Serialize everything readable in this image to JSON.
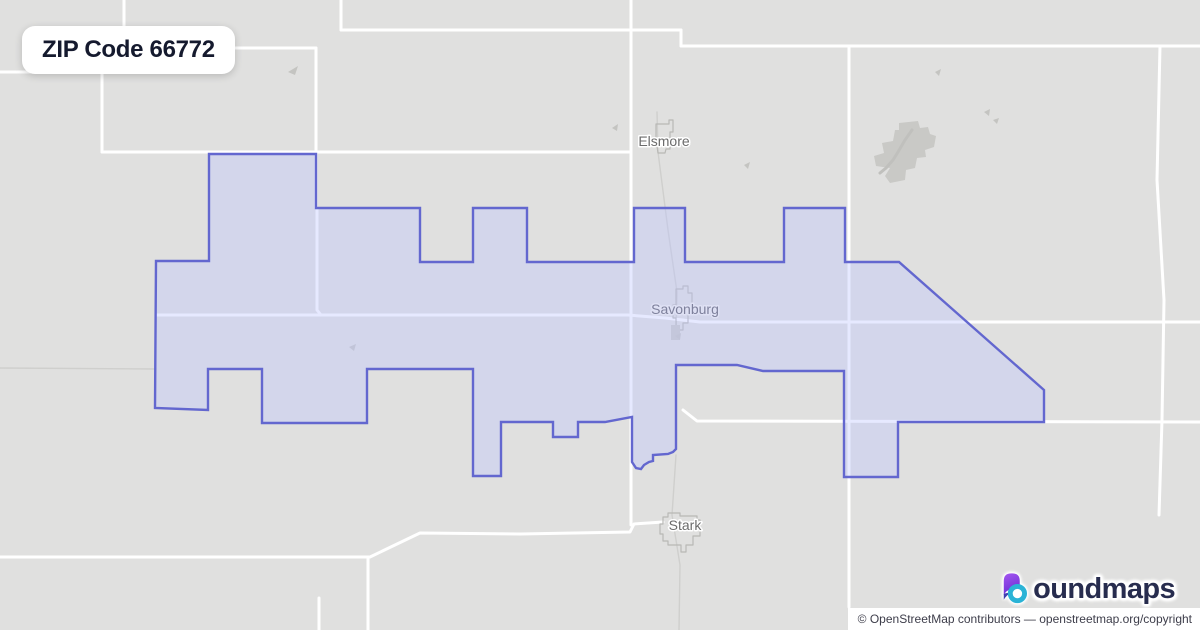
{
  "page": {
    "title_badge": "ZIP Code 66772"
  },
  "attribution": {
    "text": "© OpenStreetMap contributors — openstreetmap.org/copyright"
  },
  "logo": {
    "mark": "b-gradient-droplet-ring",
    "text": "oundmaps",
    "mark_purple_top": "#a456f0",
    "mark_purple_deep": "#6d2fd6",
    "mark_indigo_tip": "#4040b0",
    "mark_teal_ring": "#2bb3d6"
  },
  "map": {
    "width": 1200,
    "height": 630,
    "colors": {
      "base": "#e0e0df",
      "road": "#ffffff",
      "roadMinor": "#cfcfcd",
      "blob": "#c9c9c6",
      "blobInner": "#c0c0bd",
      "outline": "#b8b8b5",
      "speck": "#c4c4c1",
      "zoneFill": "rgba(190,196,255,0.38)",
      "zoneStroke": "#6367cf",
      "labelGray": "#6b6b6b",
      "labelZone": "#7e819c",
      "halo": "#ffffff",
      "haloZone": "#dfe1f4"
    },
    "zone_polygon": [
      [
        156,
        261
      ],
      [
        209,
        261
      ],
      [
        209,
        154
      ],
      [
        316,
        154
      ],
      [
        316,
        208
      ],
      [
        420,
        208
      ],
      [
        420,
        262
      ],
      [
        473,
        262
      ],
      [
        473,
        208
      ],
      [
        527,
        208
      ],
      [
        527,
        262
      ],
      [
        634,
        262
      ],
      [
        634,
        208
      ],
      [
        685,
        208
      ],
      [
        685,
        262
      ],
      [
        784,
        262
      ],
      [
        784,
        208
      ],
      [
        845,
        208
      ],
      [
        845,
        262
      ],
      [
        899,
        262
      ],
      [
        1044,
        390
      ],
      [
        1044,
        422
      ],
      [
        898,
        422
      ],
      [
        898,
        477
      ],
      [
        844,
        477
      ],
      [
        844,
        371
      ],
      [
        763,
        371
      ],
      [
        737,
        365
      ],
      [
        676,
        365
      ],
      [
        676,
        449
      ],
      [
        673,
        452
      ],
      [
        668,
        454
      ],
      [
        653,
        455
      ],
      [
        653,
        461
      ],
      [
        649,
        462
      ],
      [
        644,
        465
      ],
      [
        641,
        469
      ],
      [
        636,
        468
      ],
      [
        632,
        462
      ],
      [
        632,
        417
      ],
      [
        605,
        422
      ],
      [
        578,
        422
      ],
      [
        578,
        437
      ],
      [
        553,
        437
      ],
      [
        553,
        422
      ],
      [
        501,
        422
      ],
      [
        501,
        476
      ],
      [
        473,
        476
      ],
      [
        473,
        369
      ],
      [
        367,
        369
      ],
      [
        367,
        423
      ],
      [
        262,
        423
      ],
      [
        262,
        369
      ],
      [
        208,
        369
      ],
      [
        208,
        410
      ],
      [
        155,
        408
      ]
    ],
    "roads_major": [
      [
        [
          124,
          0
        ],
        [
          124,
          48
        ]
      ],
      [
        [
          124,
          48
        ],
        [
          316,
          48
        ]
      ],
      [
        [
          0,
          72
        ],
        [
          102,
          72
        ]
      ],
      [
        [
          102,
          72
        ],
        [
          102,
          152
        ]
      ],
      [
        [
          102,
          152
        ],
        [
          631,
          152
        ]
      ],
      [
        [
          316,
          48
        ],
        [
          316,
          208
        ]
      ],
      [
        [
          317,
          208
        ],
        [
          317,
          310
        ],
        [
          321,
          315
        ]
      ],
      [
        [
          341,
          0
        ],
        [
          341,
          30
        ]
      ],
      [
        [
          341,
          30
        ],
        [
          681,
          30
        ]
      ],
      [
        [
          681,
          30
        ],
        [
          681,
          46
        ]
      ],
      [
        [
          681,
          46
        ],
        [
          1200,
          46
        ]
      ],
      [
        [
          849,
          46
        ],
        [
          849,
          607
        ]
      ],
      [
        [
          631,
          0
        ],
        [
          631,
          525
        ]
      ],
      [
        [
          156,
          315
        ],
        [
          628,
          315
        ],
        [
          665,
          318
        ],
        [
          700,
          322
        ],
        [
          1200,
          322
        ]
      ],
      [
        [
          0,
          557
        ],
        [
          370,
          557
        ],
        [
          420,
          533
        ],
        [
          520,
          534
        ],
        [
          630,
          532
        ],
        [
          634,
          524
        ],
        [
          663,
          522
        ]
      ],
      [
        [
          368,
          557
        ],
        [
          368,
          630
        ]
      ],
      [
        [
          319,
          598
        ],
        [
          319,
          630
        ]
      ],
      [
        [
          683,
          410
        ],
        [
          697,
          421
        ],
        [
          1200,
          422
        ]
      ],
      [
        [
          1160,
          46
        ],
        [
          1157,
          180
        ],
        [
          1164,
          300
        ],
        [
          1162,
          420
        ],
        [
          1159,
          515
        ]
      ]
    ],
    "roads_minor": [
      [
        [
          657,
          112
        ],
        [
          658,
          152
        ],
        [
          668,
          230
        ],
        [
          677,
          292
        ],
        [
          676,
          332
        ]
      ],
      [
        [
          676,
          455
        ],
        [
          672,
          515
        ],
        [
          680,
          565
        ],
        [
          679,
          630
        ]
      ],
      [
        [
          0,
          368
        ],
        [
          156,
          369
        ]
      ]
    ],
    "town_outlines": [
      [
        [
          656,
          124
        ],
        [
          669,
          124
        ],
        [
          669,
          120
        ],
        [
          673,
          120
        ],
        [
          673,
          132
        ],
        [
          670,
          132
        ],
        [
          670,
          149
        ],
        [
          666,
          149
        ],
        [
          665,
          153
        ],
        [
          658,
          153
        ],
        [
          657,
          146
        ],
        [
          656,
          146
        ]
      ],
      [
        [
          676,
          289
        ],
        [
          683,
          289
        ],
        [
          683,
          286
        ],
        [
          688,
          286
        ],
        [
          688,
          293
        ],
        [
          692,
          293
        ],
        [
          692,
          312
        ],
        [
          688,
          312
        ],
        [
          688,
          323
        ],
        [
          683,
          323
        ],
        [
          683,
          330
        ],
        [
          676,
          330
        ],
        [
          676,
          318
        ],
        [
          673,
          318
        ],
        [
          673,
          305
        ],
        [
          676,
          305
        ]
      ],
      [
        [
          663,
          517
        ],
        [
          668,
          517
        ],
        [
          668,
          513
        ],
        [
          680,
          513
        ],
        [
          680,
          516
        ],
        [
          697,
          516
        ],
        [
          697,
          520
        ],
        [
          700,
          520
        ],
        [
          700,
          536
        ],
        [
          693,
          536
        ],
        [
          693,
          545
        ],
        [
          686,
          545
        ],
        [
          686,
          552
        ],
        [
          681,
          552
        ],
        [
          681,
          545
        ],
        [
          668,
          545
        ],
        [
          668,
          541
        ],
        [
          663,
          541
        ],
        [
          663,
          534
        ],
        [
          660,
          534
        ],
        [
          660,
          524
        ],
        [
          663,
          524
        ]
      ]
    ],
    "town_blocks": [
      [
        [
          671,
          325
        ],
        [
          680,
          325
        ],
        [
          680,
          340
        ],
        [
          671,
          340
        ]
      ]
    ],
    "blob": [
      [
        899,
        123
      ],
      [
        918,
        121
      ],
      [
        920,
        128
      ],
      [
        928,
        127
      ],
      [
        930,
        134
      ],
      [
        936,
        136
      ],
      [
        934,
        147
      ],
      [
        925,
        150
      ],
      [
        926,
        157
      ],
      [
        917,
        158
      ],
      [
        915,
        168
      ],
      [
        906,
        170
      ],
      [
        905,
        180
      ],
      [
        890,
        183
      ],
      [
        885,
        176
      ],
      [
        890,
        168
      ],
      [
        876,
        166
      ],
      [
        874,
        156
      ],
      [
        884,
        153
      ],
      [
        882,
        143
      ],
      [
        893,
        141
      ],
      [
        895,
        130
      ],
      [
        899,
        130
      ]
    ],
    "blob_inner": [
      [
        912,
        130
      ],
      [
        905,
        140
      ],
      [
        898,
        152
      ],
      [
        893,
        160
      ],
      [
        886,
        168
      ],
      [
        880,
        173
      ]
    ],
    "specks": [
      [
        [
          288,
          72
        ],
        [
          298,
          66
        ],
        [
          295,
          75
        ]
      ],
      [
        [
          612,
          128
        ],
        [
          618,
          124
        ],
        [
          617,
          131
        ]
      ],
      [
        [
          935,
          72
        ],
        [
          941,
          69
        ],
        [
          939,
          76
        ]
      ],
      [
        [
          984,
          112
        ],
        [
          990,
          109
        ],
        [
          989,
          116
        ]
      ],
      [
        [
          993,
          120
        ],
        [
          999,
          118
        ],
        [
          997,
          124
        ]
      ],
      [
        [
          744,
          165
        ],
        [
          750,
          162
        ],
        [
          748,
          169
        ]
      ],
      [
        [
          349,
          347
        ],
        [
          356,
          344
        ],
        [
          354,
          351
        ]
      ],
      [
        [
          675,
          336
        ],
        [
          681,
          333
        ],
        [
          680,
          340
        ]
      ]
    ],
    "towns": [
      {
        "name": "Elsmore",
        "x": 664,
        "y": 146,
        "tone": "gray"
      },
      {
        "name": "Savonburg",
        "x": 685,
        "y": 314,
        "tone": "zone"
      },
      {
        "name": "Stark",
        "x": 685,
        "y": 530,
        "tone": "gray"
      }
    ]
  }
}
